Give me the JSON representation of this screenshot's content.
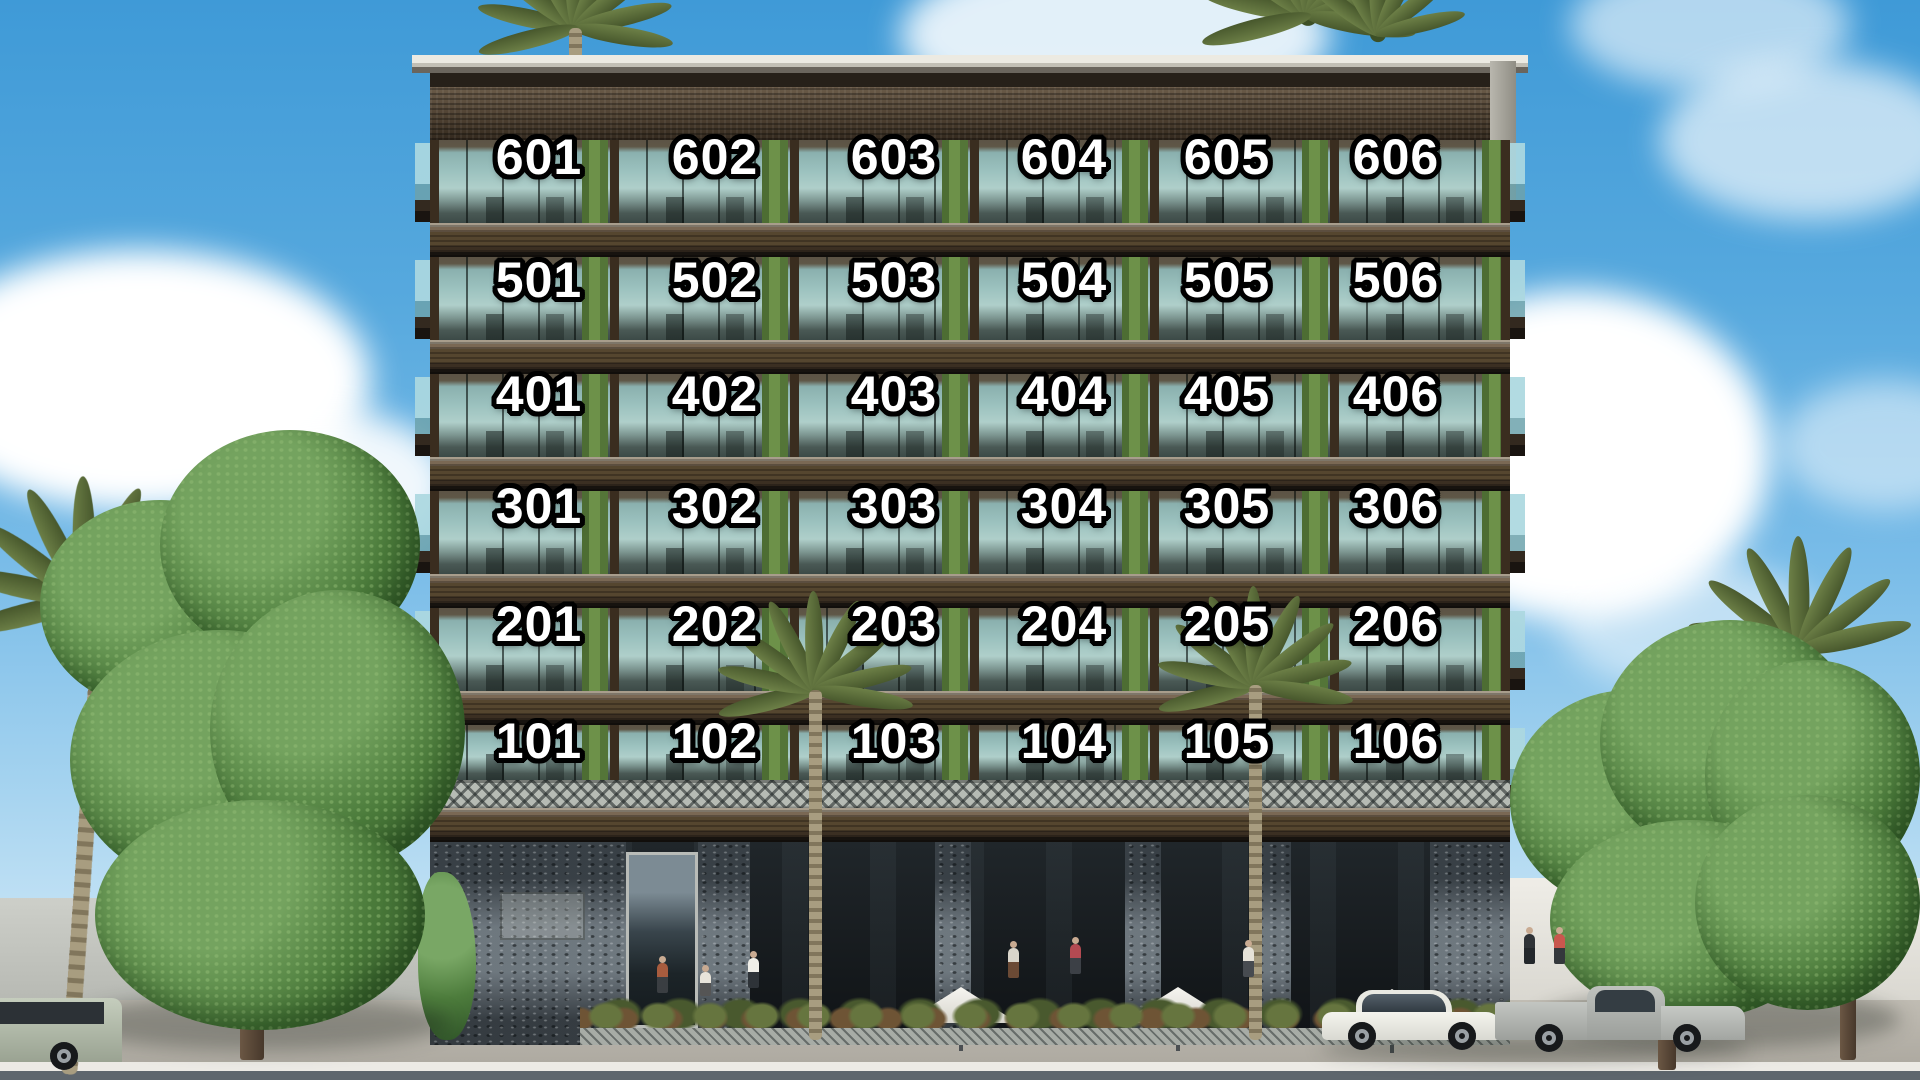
{
  "building": {
    "floors": [
      {
        "level": "6",
        "units": [
          "601",
          "602",
          "603",
          "604",
          "605",
          "606"
        ]
      },
      {
        "level": "5",
        "units": [
          "501",
          "502",
          "503",
          "504",
          "505",
          "506"
        ]
      },
      {
        "level": "4",
        "units": [
          "401",
          "402",
          "403",
          "404",
          "405",
          "406"
        ]
      },
      {
        "level": "3",
        "units": [
          "301",
          "302",
          "303",
          "304",
          "305",
          "306"
        ]
      },
      {
        "level": "2",
        "units": [
          "201",
          "202",
          "203",
          "204",
          "205",
          "206"
        ]
      },
      {
        "level": "1",
        "units": [
          "101",
          "102",
          "103",
          "104",
          "105",
          "106"
        ]
      }
    ]
  },
  "colors": {
    "label_text": "#ffffff",
    "label_outline": "#000000",
    "sky_top": "#3f9ad7",
    "sky_horizon": "#e4f1fa",
    "facade_wood": "#55462f",
    "glass_teal": "#9cc2bf",
    "planting_green": "#6d9149",
    "stone_gray": "#59626a",
    "sidewalk_gray": "#b6b2a9",
    "road_gray": "#5e666d"
  }
}
